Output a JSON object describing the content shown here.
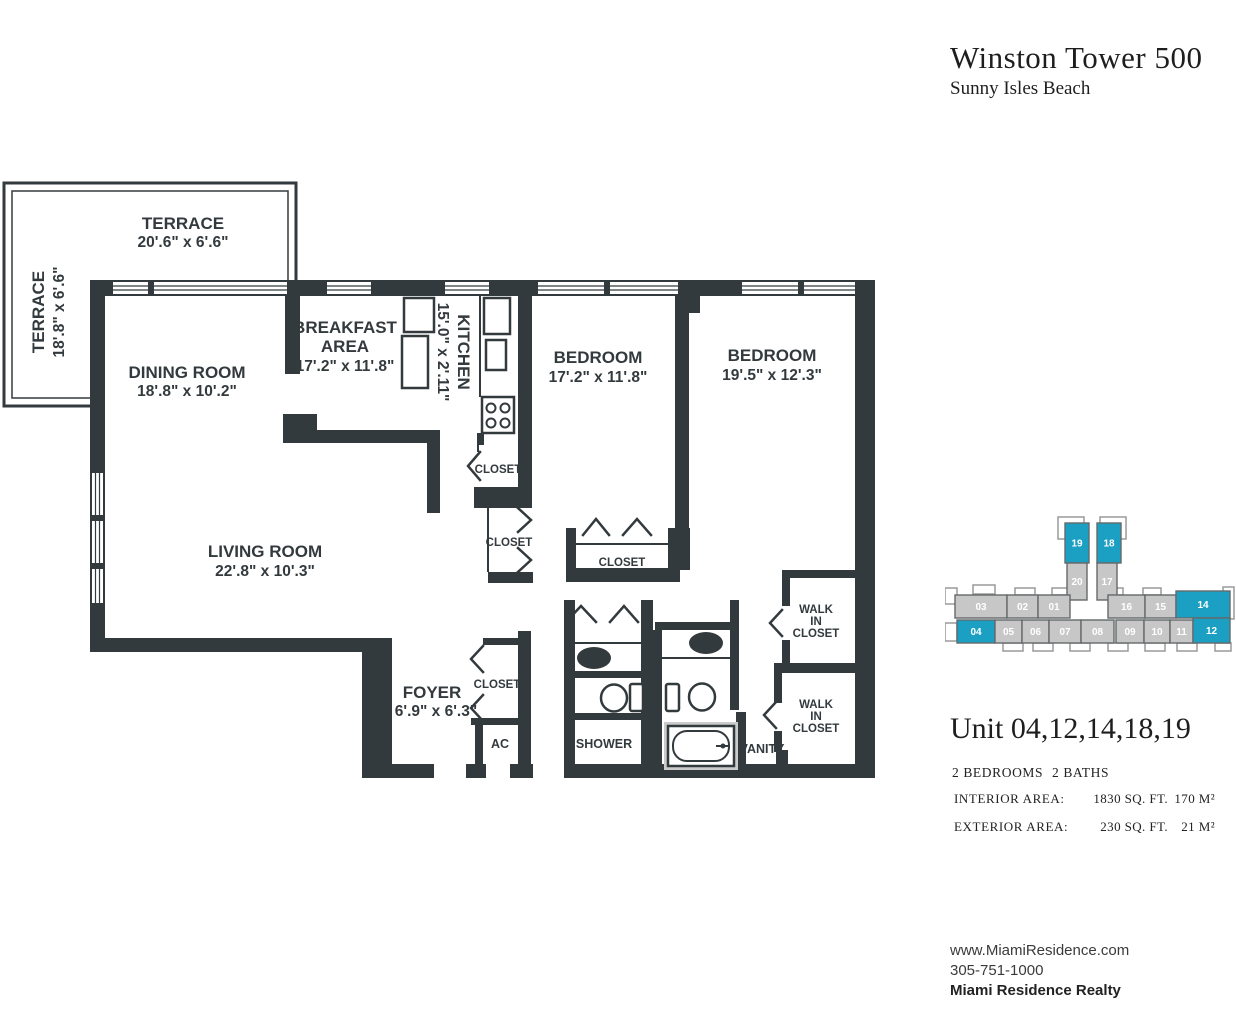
{
  "header": {
    "title": "Winston Tower 500",
    "subtitle": "Sunny Isles Beach"
  },
  "floorplan": {
    "terrace_top": {
      "name": "TERRACE",
      "dims": "20'.6\" x 6'.6\""
    },
    "terrace_side": {
      "name": "TERRACE",
      "dims": "18'.8\" x 6'.6\""
    },
    "dining": {
      "name": "DINING ROOM",
      "dims": "18'.8\" x 10'.2\""
    },
    "breakfast": {
      "line1": "BREAKFAST",
      "line2": "AREA",
      "dims": "17'.2\" x 11'.8\""
    },
    "kitchen": {
      "name": "KITCHEN",
      "dims": "15'.0\" x 2'.11\""
    },
    "bedroom1": {
      "name": "BEDROOM",
      "dims": "17'.2\" x 11'.8\""
    },
    "bedroom2": {
      "name": "BEDROOM",
      "dims": "19'.5\" x 12'.3\""
    },
    "living": {
      "name": "LIVING ROOM",
      "dims": "22'.8\" x 10'.3\""
    },
    "foyer": {
      "name": "FOYER",
      "dims": "6'.9\" x 6'.3\""
    },
    "closet_kitchen": "CLOSET",
    "closet_hall": "CLOSET",
    "closet_bedroom": "CLOSET",
    "closet_foyer": "CLOSET",
    "ac": "AC",
    "shower": "SHOWER",
    "vanity": "VANITY",
    "wic1": {
      "l1": "WALK",
      "l2": "IN",
      "l3": "CLOSET"
    },
    "wic2": {
      "l1": "WALK",
      "l2": "IN",
      "l3": "CLOSET"
    }
  },
  "unit_map": {
    "highlight_color": "#1BA0C4",
    "unit_color": "#C7C7C7",
    "border_color": "#64696B",
    "units": [
      {
        "label": "19",
        "highlighted": true
      },
      {
        "label": "18",
        "highlighted": true
      },
      {
        "label": "20",
        "highlighted": false
      },
      {
        "label": "17",
        "highlighted": false
      },
      {
        "label": "03",
        "highlighted": false
      },
      {
        "label": "02",
        "highlighted": false
      },
      {
        "label": "01",
        "highlighted": false
      },
      {
        "label": "16",
        "highlighted": false
      },
      {
        "label": "15",
        "highlighted": false
      },
      {
        "label": "14",
        "highlighted": true
      },
      {
        "label": "04",
        "highlighted": true
      },
      {
        "label": "05",
        "highlighted": false
      },
      {
        "label": "06",
        "highlighted": false
      },
      {
        "label": "07",
        "highlighted": false
      },
      {
        "label": "08",
        "highlighted": false
      },
      {
        "label": "09",
        "highlighted": false
      },
      {
        "label": "10",
        "highlighted": false
      },
      {
        "label": "11",
        "highlighted": false
      },
      {
        "label": "12",
        "highlighted": true
      }
    ]
  },
  "unit_info": {
    "title": "Unit 04,12,14,18,19",
    "bedrooms": "2 BEDROOMS",
    "baths": "2 BATHS",
    "interior_label": "INTERIOR AREA:",
    "interior_sqft": "1830 SQ. FT.",
    "interior_m2": "170 M²",
    "exterior_label": "EXTERIOR AREA:",
    "exterior_sqft": "230 SQ. FT.",
    "exterior_m2": "21 M²"
  },
  "footer": {
    "website": "www.MiamiResidence.com",
    "phone": "305-751-1000",
    "company": "Miami Residence Realty"
  }
}
